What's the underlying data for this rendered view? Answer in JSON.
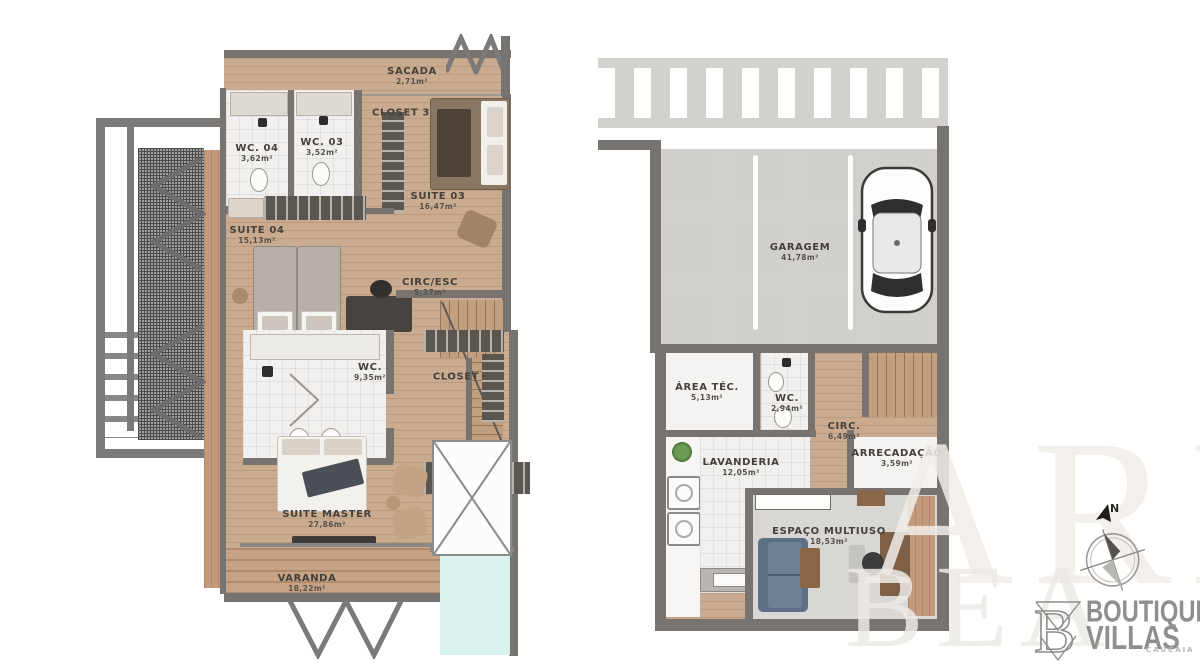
{
  "document": {
    "type": "residential floor plans",
    "floors": [
      "upper floor",
      "ground floor"
    ]
  },
  "palette": {
    "wall": "#767371",
    "wood": "#cbab90",
    "deck": "#c8a284",
    "concrete": "#d1d0cd",
    "tile": "#f1f0ee",
    "pool": "#d9f2ee",
    "couch": "#5c7086",
    "label_text": "#44413c",
    "logo_gray": "#8f8f8d"
  },
  "floor_upper": {
    "rooms": [
      {
        "label": "SACADA",
        "area": "2,71m²"
      },
      {
        "label": "CLOSET 3",
        "area": ""
      },
      {
        "label": "WC. 04",
        "area": "3,62m²"
      },
      {
        "label": "WC. 03",
        "area": "3,52m²"
      },
      {
        "label": "SUITE 03",
        "area": "16,47m²"
      },
      {
        "label": "SUITE 04",
        "area": "15,13m²"
      },
      {
        "label": "CIRC/ESC",
        "area": "5,37m²"
      },
      {
        "label": "WC.",
        "area": "9,35m²"
      },
      {
        "label": "CLOSET",
        "area": ""
      },
      {
        "label": "SUITE MASTER",
        "area": "27,86m²"
      },
      {
        "label": "VARANDA",
        "area": "18,22m²"
      }
    ]
  },
  "floor_ground": {
    "rooms": [
      {
        "label": "GARAGEM",
        "area": "41,78m²"
      },
      {
        "label": "ÁREA TÉC.",
        "area": "5,13m²"
      },
      {
        "label": "WC.",
        "area": "2,94m²"
      },
      {
        "label": "CIRC.",
        "area": "6,49m²"
      },
      {
        "label": "ARRECADAÇÃO",
        "area": "3,59m²"
      },
      {
        "label": "LAVANDERIA",
        "area": "12,05m²"
      },
      {
        "label": "ESPAÇO MULTIUSO",
        "area": "18,53m²"
      }
    ]
  },
  "compass": {
    "north_label": "N"
  },
  "watermark": {
    "line1": "ARE",
    "line2": "BEA"
  },
  "logo": {
    "monogram": "B",
    "brand_line1": "BOUTIQUE",
    "brand_line2": "VILLAS",
    "sub_label": "CAUCAIA"
  }
}
